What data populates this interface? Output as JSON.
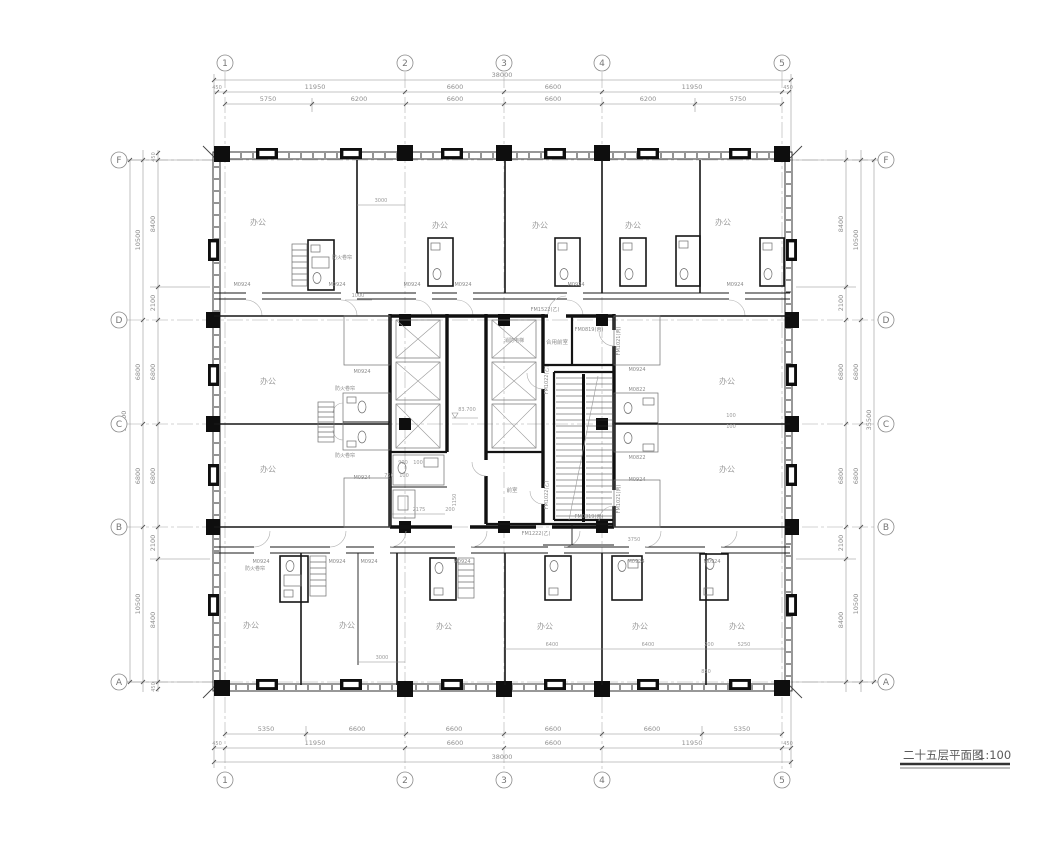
{
  "drawing": {
    "title": "二十五层平面图",
    "scale": "1:100",
    "elevation": "83.700"
  },
  "grid": {
    "cols": [
      "1",
      "2",
      "3",
      "4",
      "5"
    ],
    "rows": [
      "F",
      "D",
      "C",
      "B",
      "A"
    ]
  },
  "dims": {
    "top": {
      "total": "38000",
      "row1": [
        "450",
        "11950",
        "6600",
        "6600",
        "11950",
        "450"
      ],
      "row2": [
        "5750",
        "6200",
        "6600",
        "6600",
        "6200",
        "5750"
      ]
    },
    "bottom": {
      "total": "38000",
      "row1": [
        "450",
        "11950",
        "6600",
        "6600",
        "11950",
        "450"
      ],
      "row2": [
        "5350",
        "6600",
        "6600",
        "6600",
        "6600",
        "5350"
      ]
    },
    "left": {
      "total": "35500",
      "col1": [
        "10500",
        "6800",
        "6800",
        "10500"
      ],
      "col2": [
        "450",
        "8400",
        "2100",
        "6800",
        "6800",
        "2100",
        "8400",
        "450"
      ]
    },
    "right": {
      "total": "35500",
      "col1": [
        "10500",
        "6800",
        "6800",
        "10500"
      ],
      "col2": [
        "8400",
        "2100",
        "6800",
        "6800",
        "2100",
        "8400"
      ]
    }
  },
  "rooms": {
    "office": "办公",
    "shared_lobby": "合用前室",
    "front_room": "前室",
    "fire_elevator": "消防电梯"
  },
  "doors": {
    "m0924": "M0924",
    "m0822": "M0822",
    "fm1522": "FM1522(乙)",
    "fm1022": "FM1022(乙)",
    "fm0819": "FM0819(丙)",
    "fm1222": "FM1222(乙)",
    "fm1021": "FM1021(丙)",
    "shutter": "防火卷帘"
  },
  "inner_dims": {
    "d3000": "3000",
    "d1000": "1000",
    "d2175": "2175",
    "d200": "200",
    "d3750": "3750",
    "d6400": "6400",
    "d5250": "5250",
    "d850": "850",
    "d100": "100",
    "d900": "900",
    "d750": "750",
    "d1150": "1150"
  }
}
